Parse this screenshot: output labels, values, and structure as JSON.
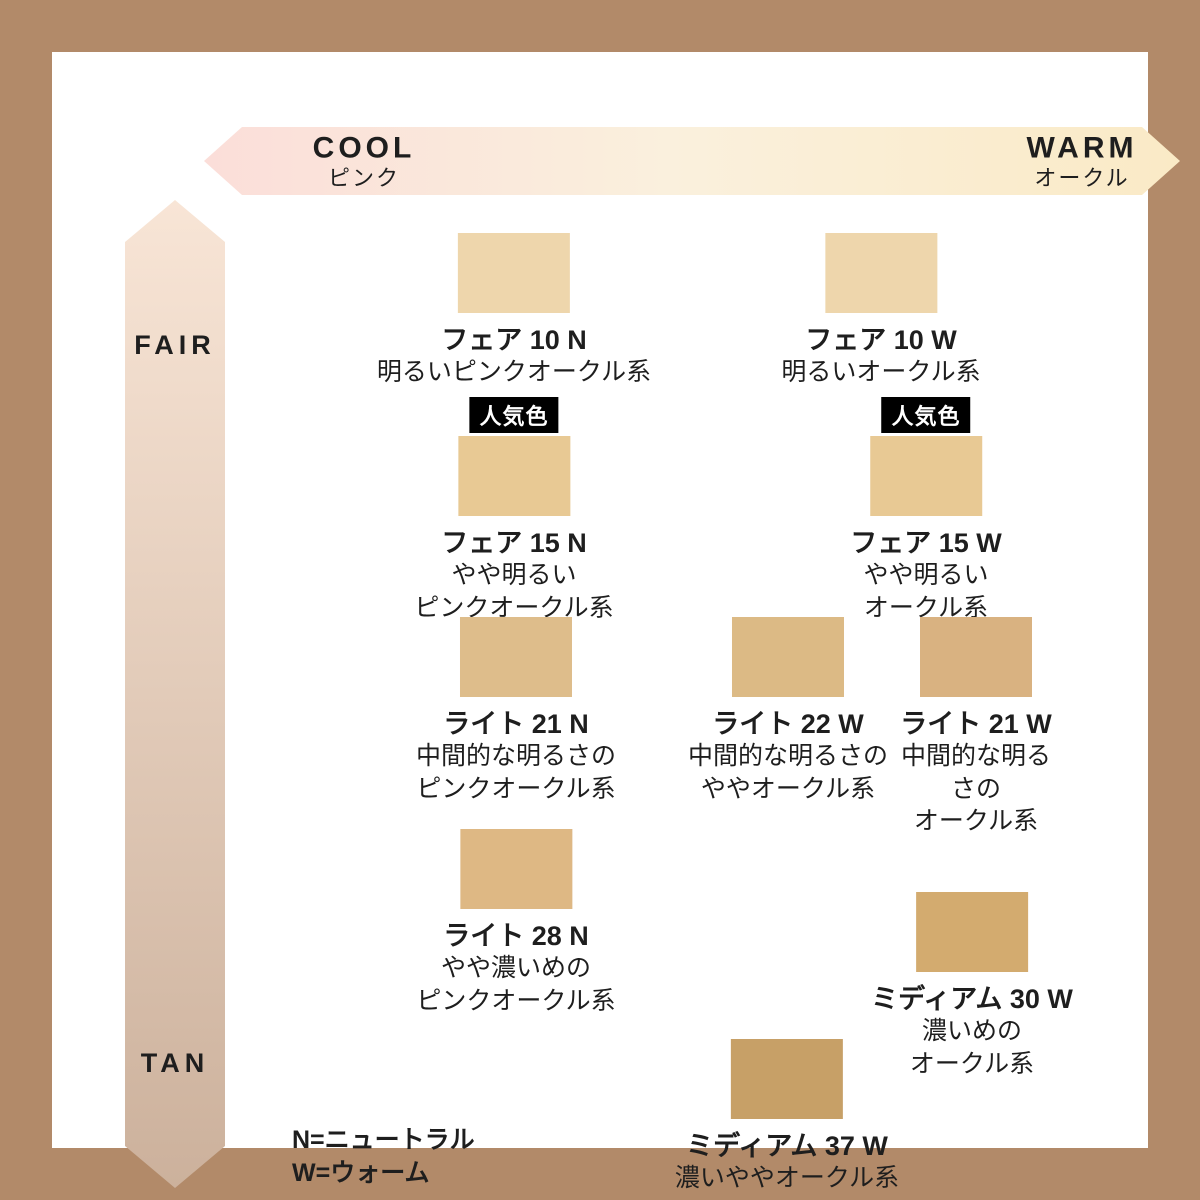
{
  "axis_horizontal": {
    "left_label": "COOL",
    "left_sublabel": "ピンク",
    "right_label": "WARM",
    "right_sublabel": "オークル"
  },
  "axis_vertical": {
    "top_label": "FAIR",
    "bottom_label": "TAN"
  },
  "popular_badge_label": "人気色",
  "legend": {
    "neutral": "N=ニュートラル",
    "warm": "W=ウォーム"
  },
  "colors": {
    "frame": "#b28a69",
    "text": "#1e1e1e",
    "arrow_cool": "#fbded9",
    "arrow_mid": "#faf0dd",
    "arrow_warm": "#faeac6",
    "arrow_fair": "#f8e5d6",
    "arrow_tan": "#ccb19c",
    "badge_bg": "#000000",
    "badge_text": "#ffffff"
  },
  "shades": [
    {
      "name": "フェア 10 N",
      "desc": "明るいピンクオークル系",
      "color": "#eed6ac",
      "popular": false
    },
    {
      "name": "フェア 10 W",
      "desc": "明るいオークル系",
      "color": "#eed6ac",
      "popular": false
    },
    {
      "name": "フェア 15 N",
      "desc": "やや明るい\nピンクオークル系",
      "color": "#e8c994",
      "popular": true
    },
    {
      "name": "フェア 15 W",
      "desc": "やや明るい\nオークル系",
      "color": "#e8c994",
      "popular": true
    },
    {
      "name": "ライト 21 N",
      "desc": "中間的な明るさの\nピンクオークル系",
      "color": "#debd8b",
      "popular": false
    },
    {
      "name": "ライト 22 W",
      "desc": "中間的な明るさの\nややオークル系",
      "color": "#dcba85",
      "popular": false
    },
    {
      "name": "ライト 21 W",
      "desc": "中間的な明るさの\nオークル系",
      "color": "#d9b281",
      "popular": false
    },
    {
      "name": "ライト 28 N",
      "desc": "やや濃いめの\nピンクオークル系",
      "color": "#deb884",
      "popular": false
    },
    {
      "name": "ミディアム 30 W",
      "desc": "濃いめの\nオークル系",
      "color": "#d3ab6f",
      "popular": false
    },
    {
      "name": "ミディアム 37 W",
      "desc": "濃いややオークル系",
      "color": "#c7a067",
      "popular": false
    }
  ]
}
